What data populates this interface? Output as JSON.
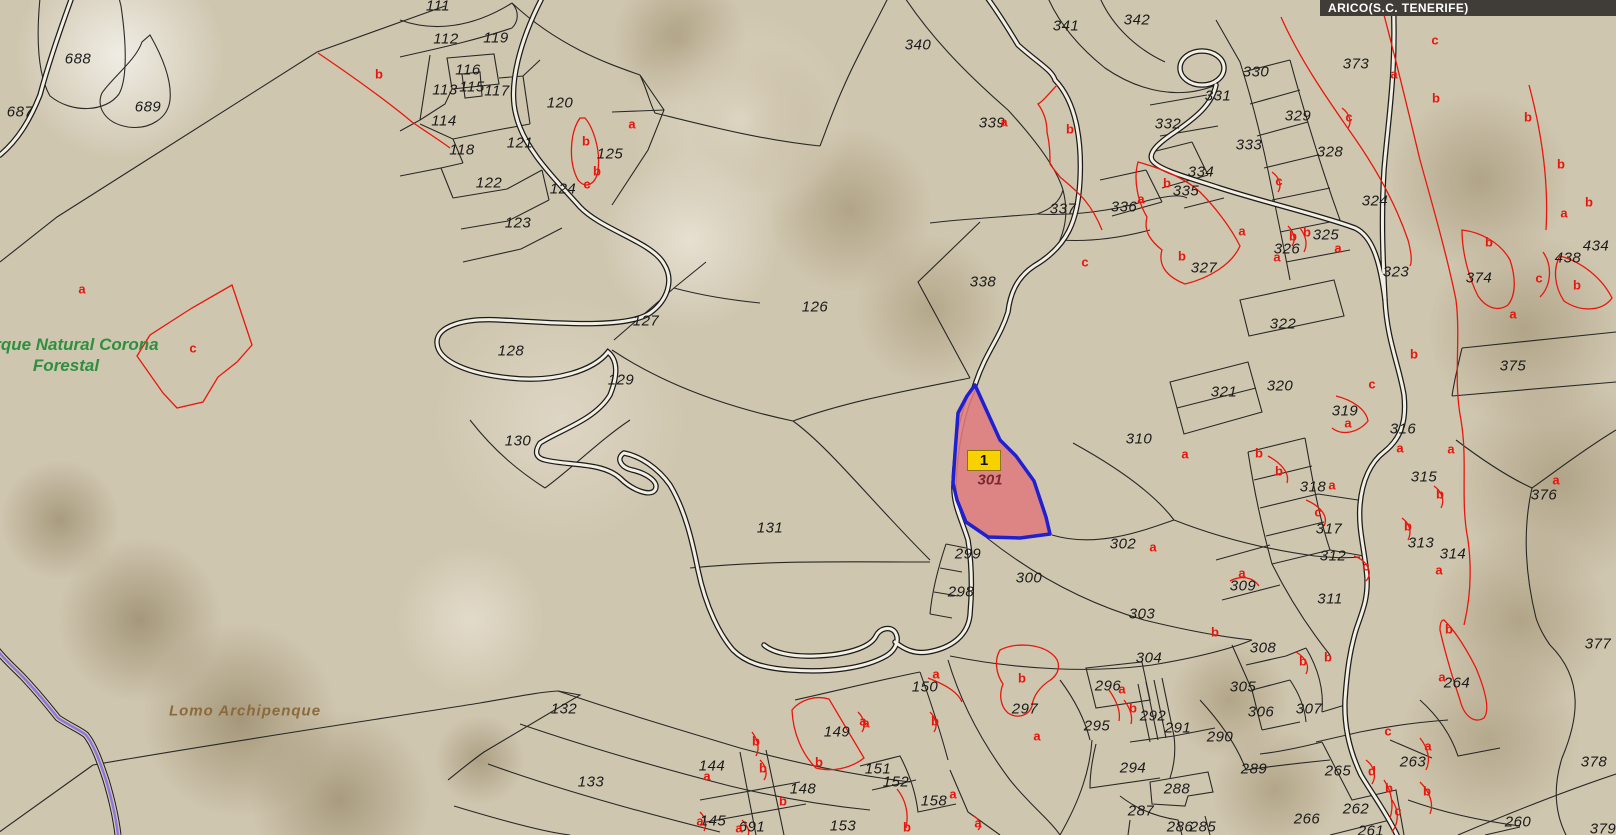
{
  "banner": {
    "text": "ARICO(S.C. TENERIFE)"
  },
  "highlight": {
    "badge": "1",
    "parcel_number": "301",
    "x": 990,
    "y": 480
  },
  "park_label": {
    "line1": "Parque Natural Corona",
    "line2": "Forestal",
    "x": 66,
    "y": 355
  },
  "ridge_label": {
    "text": "Lomo Archipenque",
    "x": 245,
    "y": 711
  },
  "colors": {
    "boundary": "#1a1a1a",
    "subparcel": "#e8170d",
    "highlight_fill": "#df7b80",
    "highlight_stroke": "#2020cf",
    "badge_bg": "#f8d200",
    "park_text": "#2f8f3f",
    "ridge_text": "#8a6a3a",
    "banner_bg": "#403d38",
    "banner_text": "#ffffff",
    "road_fill": "#f2eee2",
    "stream": "#8f74e0"
  },
  "parcel_labels": [
    {
      "t": "688",
      "x": 78,
      "y": 59
    },
    {
      "t": "687",
      "x": 20,
      "y": 112
    },
    {
      "t": "689",
      "x": 148,
      "y": 107
    },
    {
      "t": "111",
      "x": 438,
      "y": 6
    },
    {
      "t": "112",
      "x": 446,
      "y": 39
    },
    {
      "t": "119",
      "x": 496,
      "y": 38
    },
    {
      "t": "116",
      "x": 468,
      "y": 70
    },
    {
      "t": "113",
      "x": 445,
      "y": 90
    },
    {
      "t": "115",
      "x": 472,
      "y": 87
    },
    {
      "t": "117",
      "x": 497,
      "y": 91
    },
    {
      "t": "120",
      "x": 560,
      "y": 103
    },
    {
      "t": "114",
      "x": 444,
      "y": 121
    },
    {
      "t": "118",
      "x": 462,
      "y": 150
    },
    {
      "t": "121",
      "x": 520,
      "y": 143
    },
    {
      "t": "125",
      "x": 610,
      "y": 154
    },
    {
      "t": "122",
      "x": 489,
      "y": 183
    },
    {
      "t": "124",
      "x": 563,
      "y": 189
    },
    {
      "t": "123",
      "x": 518,
      "y": 223
    },
    {
      "t": "126",
      "x": 815,
      "y": 307
    },
    {
      "t": "127",
      "x": 646,
      "y": 321
    },
    {
      "t": "128",
      "x": 511,
      "y": 351
    },
    {
      "t": "129",
      "x": 621,
      "y": 380
    },
    {
      "t": "130",
      "x": 518,
      "y": 441
    },
    {
      "t": "131",
      "x": 770,
      "y": 528
    },
    {
      "t": "132",
      "x": 564,
      "y": 709
    },
    {
      "t": "133",
      "x": 591,
      "y": 782
    },
    {
      "t": "144",
      "x": 712,
      "y": 766
    },
    {
      "t": "145",
      "x": 713,
      "y": 821
    },
    {
      "t": "691",
      "x": 752,
      "y": 827
    },
    {
      "t": "148",
      "x": 803,
      "y": 789
    },
    {
      "t": "149",
      "x": 837,
      "y": 732
    },
    {
      "t": "150",
      "x": 925,
      "y": 687
    },
    {
      "t": "151",
      "x": 878,
      "y": 769
    },
    {
      "t": "152",
      "x": 896,
      "y": 782
    },
    {
      "t": "153",
      "x": 843,
      "y": 826
    },
    {
      "t": "158",
      "x": 934,
      "y": 801
    },
    {
      "t": "340",
      "x": 918,
      "y": 45
    },
    {
      "t": "341",
      "x": 1066,
      "y": 26
    },
    {
      "t": "342",
      "x": 1137,
      "y": 20
    },
    {
      "t": "339",
      "x": 992,
      "y": 123
    },
    {
      "t": "331",
      "x": 1218,
      "y": 96
    },
    {
      "t": "332",
      "x": 1168,
      "y": 124
    },
    {
      "t": "334",
      "x": 1201,
      "y": 172
    },
    {
      "t": "335",
      "x": 1186,
      "y": 191
    },
    {
      "t": "336",
      "x": 1124,
      "y": 207
    },
    {
      "t": "337",
      "x": 1063,
      "y": 209
    },
    {
      "t": "338",
      "x": 983,
      "y": 282
    },
    {
      "t": "327",
      "x": 1204,
      "y": 268
    },
    {
      "t": "330",
      "x": 1256,
      "y": 72
    },
    {
      "t": "373",
      "x": 1356,
      "y": 64
    },
    {
      "t": "329",
      "x": 1298,
      "y": 116
    },
    {
      "t": "333",
      "x": 1249,
      "y": 145
    },
    {
      "t": "328",
      "x": 1330,
      "y": 152
    },
    {
      "t": "324",
      "x": 1375,
      "y": 201
    },
    {
      "t": "325",
      "x": 1326,
      "y": 235
    },
    {
      "t": "326",
      "x": 1287,
      "y": 249
    },
    {
      "t": "323",
      "x": 1396,
      "y": 272
    },
    {
      "t": "374",
      "x": 1479,
      "y": 278
    },
    {
      "t": "434",
      "x": 1596,
      "y": 246
    },
    {
      "t": "438",
      "x": 1568,
      "y": 258
    },
    {
      "t": "322",
      "x": 1283,
      "y": 324
    },
    {
      "t": "375",
      "x": 1513,
      "y": 366
    },
    {
      "t": "321",
      "x": 1224,
      "y": 392
    },
    {
      "t": "320",
      "x": 1280,
      "y": 386
    },
    {
      "t": "319",
      "x": 1345,
      "y": 411
    },
    {
      "t": "316",
      "x": 1403,
      "y": 429
    },
    {
      "t": "318",
      "x": 1313,
      "y": 487
    },
    {
      "t": "317",
      "x": 1329,
      "y": 529
    },
    {
      "t": "312",
      "x": 1333,
      "y": 556
    },
    {
      "t": "311",
      "x": 1330,
      "y": 599
    },
    {
      "t": "309",
      "x": 1243,
      "y": 586
    },
    {
      "t": "315",
      "x": 1424,
      "y": 477
    },
    {
      "t": "313",
      "x": 1421,
      "y": 543
    },
    {
      "t": "314",
      "x": 1453,
      "y": 554
    },
    {
      "t": "376",
      "x": 1544,
      "y": 495
    },
    {
      "t": "310",
      "x": 1139,
      "y": 439
    },
    {
      "t": "302",
      "x": 1123,
      "y": 544
    },
    {
      "t": "299",
      "x": 968,
      "y": 554
    },
    {
      "t": "300",
      "x": 1029,
      "y": 578
    },
    {
      "t": "298",
      "x": 961,
      "y": 592
    },
    {
      "t": "303",
      "x": 1142,
      "y": 614
    },
    {
      "t": "304",
      "x": 1149,
      "y": 658
    },
    {
      "t": "296",
      "x": 1108,
      "y": 686
    },
    {
      "t": "295",
      "x": 1097,
      "y": 726
    },
    {
      "t": "292",
      "x": 1153,
      "y": 716
    },
    {
      "t": "291",
      "x": 1178,
      "y": 728
    },
    {
      "t": "290",
      "x": 1220,
      "y": 737
    },
    {
      "t": "294",
      "x": 1133,
      "y": 768
    },
    {
      "t": "288",
      "x": 1177,
      "y": 789
    },
    {
      "t": "287",
      "x": 1141,
      "y": 811
    },
    {
      "t": "286",
      "x": 1180,
      "y": 827
    },
    {
      "t": "285",
      "x": 1203,
      "y": 827
    },
    {
      "t": "289",
      "x": 1254,
      "y": 769
    },
    {
      "t": "305",
      "x": 1243,
      "y": 687
    },
    {
      "t": "306",
      "x": 1261,
      "y": 712
    },
    {
      "t": "307",
      "x": 1309,
      "y": 709
    },
    {
      "t": "308",
      "x": 1263,
      "y": 648
    },
    {
      "t": "265",
      "x": 1338,
      "y": 771
    },
    {
      "t": "263",
      "x": 1413,
      "y": 762
    },
    {
      "t": "264",
      "x": 1457,
      "y": 683
    },
    {
      "t": "262",
      "x": 1356,
      "y": 809
    },
    {
      "t": "266",
      "x": 1307,
      "y": 819
    },
    {
      "t": "260",
      "x": 1518,
      "y": 822
    },
    {
      "t": "261",
      "x": 1371,
      "y": 831
    },
    {
      "t": "377",
      "x": 1598,
      "y": 644
    },
    {
      "t": "378",
      "x": 1594,
      "y": 762
    },
    {
      "t": "379",
      "x": 1603,
      "y": 829
    },
    {
      "t": "297",
      "x": 1025,
      "y": 709
    }
  ],
  "subparcel_labels": [
    {
      "t": "b",
      "x": 379,
      "y": 74
    },
    {
      "t": "a",
      "x": 632,
      "y": 124
    },
    {
      "t": "b",
      "x": 586,
      "y": 141
    },
    {
      "t": "b",
      "x": 597,
      "y": 171
    },
    {
      "t": "c",
      "x": 587,
      "y": 184
    },
    {
      "t": "a",
      "x": 82,
      "y": 289
    },
    {
      "t": "c",
      "x": 193,
      "y": 348
    },
    {
      "t": "a",
      "x": 1004,
      "y": 122
    },
    {
      "t": "b",
      "x": 1070,
      "y": 129
    },
    {
      "t": "b",
      "x": 1167,
      "y": 183
    },
    {
      "t": "a",
      "x": 1141,
      "y": 199
    },
    {
      "t": "c",
      "x": 1085,
      "y": 262
    },
    {
      "t": "b",
      "x": 1182,
      "y": 256
    },
    {
      "t": "a",
      "x": 1394,
      "y": 74
    },
    {
      "t": "c",
      "x": 1435,
      "y": 40
    },
    {
      "t": "b",
      "x": 1436,
      "y": 98
    },
    {
      "t": "c",
      "x": 1349,
      "y": 117
    },
    {
      "t": "c",
      "x": 1279,
      "y": 181
    },
    {
      "t": "b",
      "x": 1528,
      "y": 117
    },
    {
      "t": "b",
      "x": 1561,
      "y": 164
    },
    {
      "t": "b",
      "x": 1589,
      "y": 202
    },
    {
      "t": "a",
      "x": 1564,
      "y": 213
    },
    {
      "t": "a",
      "x": 1242,
      "y": 231
    },
    {
      "t": "b",
      "x": 1293,
      "y": 236
    },
    {
      "t": "b",
      "x": 1307,
      "y": 232
    },
    {
      "t": "a",
      "x": 1277,
      "y": 257
    },
    {
      "t": "a",
      "x": 1338,
      "y": 248
    },
    {
      "t": "b",
      "x": 1489,
      "y": 242
    },
    {
      "t": "c",
      "x": 1539,
      "y": 278
    },
    {
      "t": "b",
      "x": 1577,
      "y": 285
    },
    {
      "t": "a",
      "x": 1513,
      "y": 314
    },
    {
      "t": "b",
      "x": 1414,
      "y": 354
    },
    {
      "t": "c",
      "x": 1372,
      "y": 384
    },
    {
      "t": "a",
      "x": 1348,
      "y": 423
    },
    {
      "t": "b",
      "x": 1259,
      "y": 453
    },
    {
      "t": "b",
      "x": 1279,
      "y": 471
    },
    {
      "t": "a",
      "x": 1332,
      "y": 485
    },
    {
      "t": "c",
      "x": 1318,
      "y": 512
    },
    {
      "t": "a",
      "x": 1400,
      "y": 448
    },
    {
      "t": "a",
      "x": 1451,
      "y": 449
    },
    {
      "t": "b",
      "x": 1440,
      "y": 494
    },
    {
      "t": "b",
      "x": 1408,
      "y": 526
    },
    {
      "t": "a",
      "x": 1439,
      "y": 570
    },
    {
      "t": "a",
      "x": 1556,
      "y": 480
    },
    {
      "t": "c",
      "x": 1366,
      "y": 566
    },
    {
      "t": "a",
      "x": 1242,
      "y": 573
    },
    {
      "t": "b",
      "x": 1449,
      "y": 629
    },
    {
      "t": "a",
      "x": 1185,
      "y": 454
    },
    {
      "t": "a",
      "x": 1153,
      "y": 547
    },
    {
      "t": "b",
      "x": 1215,
      "y": 632
    },
    {
      "t": "b",
      "x": 1303,
      "y": 661
    },
    {
      "t": "b",
      "x": 1328,
      "y": 657
    },
    {
      "t": "c",
      "x": 1388,
      "y": 731
    },
    {
      "t": "a",
      "x": 1428,
      "y": 746
    },
    {
      "t": "d",
      "x": 1372,
      "y": 771
    },
    {
      "t": "b",
      "x": 1389,
      "y": 788
    },
    {
      "t": "b",
      "x": 1427,
      "y": 791
    },
    {
      "t": "c",
      "x": 1398,
      "y": 811
    },
    {
      "t": "a",
      "x": 1442,
      "y": 677
    },
    {
      "t": "a",
      "x": 936,
      "y": 674
    },
    {
      "t": "b",
      "x": 935,
      "y": 721
    },
    {
      "t": "a",
      "x": 863,
      "y": 721
    },
    {
      "t": "b",
      "x": 1022,
      "y": 678
    },
    {
      "t": "a",
      "x": 1037,
      "y": 736
    },
    {
      "t": "a",
      "x": 1122,
      "y": 689
    },
    {
      "t": "b",
      "x": 1133,
      "y": 708
    },
    {
      "t": "a",
      "x": 866,
      "y": 723
    },
    {
      "t": "b",
      "x": 819,
      "y": 762
    },
    {
      "t": "b",
      "x": 783,
      "y": 801
    },
    {
      "t": "a",
      "x": 707,
      "y": 776
    },
    {
      "t": "b",
      "x": 756,
      "y": 741
    },
    {
      "t": "b",
      "x": 763,
      "y": 768
    },
    {
      "t": "a",
      "x": 700,
      "y": 821
    },
    {
      "t": "a",
      "x": 739,
      "y": 828
    },
    {
      "t": "a",
      "x": 953,
      "y": 794
    },
    {
      "t": "b",
      "x": 907,
      "y": 827
    },
    {
      "t": "a",
      "x": 978,
      "y": 823
    }
  ]
}
